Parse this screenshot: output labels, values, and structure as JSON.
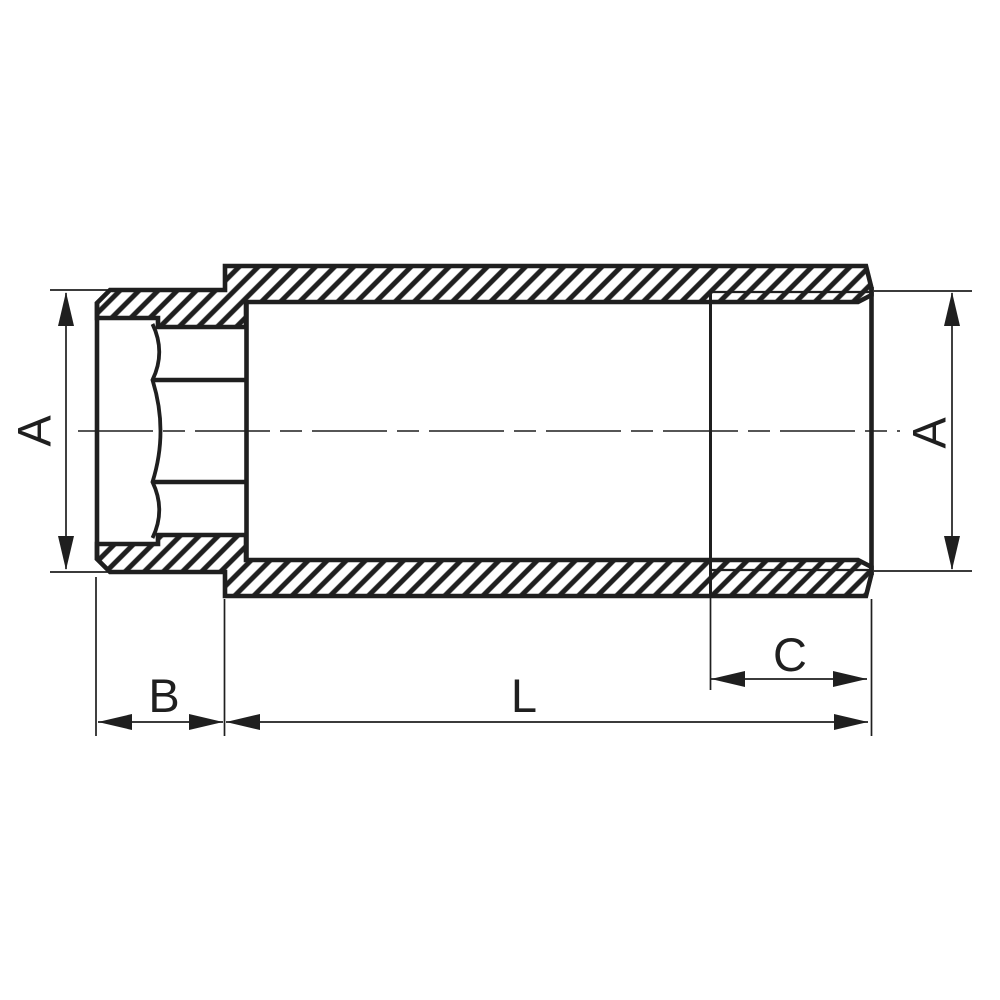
{
  "drawing": {
    "description": "Cross-section technical drawing of a pipe extension fitting (female thread left, male thread right)",
    "labels": {
      "dim_a_left": "A",
      "dim_a_right": "A",
      "dim_b": "B",
      "dim_l": "L",
      "dim_c": "C"
    },
    "colors": {
      "line": "#1f1f1f",
      "background": "#ffffff"
    }
  }
}
